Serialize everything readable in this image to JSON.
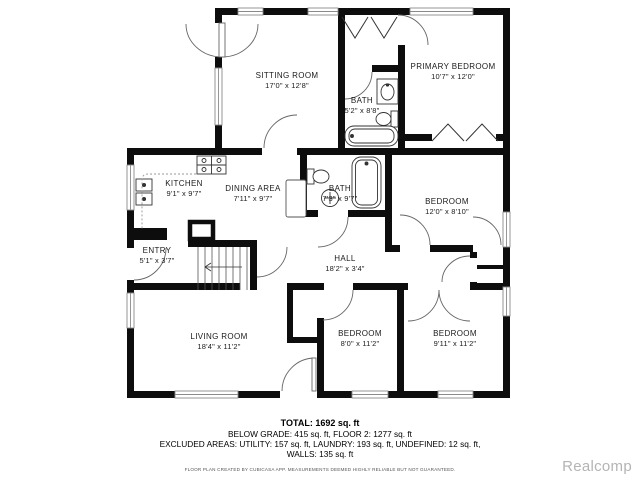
{
  "rooms": {
    "sitting_room": {
      "name": "SITTING ROOM",
      "dims": "17'0\" x 12'8\""
    },
    "bath_upper": {
      "name": "BATH",
      "dims": "5'2\" x 8'8\""
    },
    "primary": {
      "name": "PRIMARY BEDROOM",
      "dims": "10'7\" x 12'0\""
    },
    "kitchen": {
      "name": "KITCHEN",
      "dims": "9'1\" x 9'7\""
    },
    "dining": {
      "name": "DINING AREA",
      "dims": "7'11\" x 9'7\""
    },
    "bath_main": {
      "name": "BATH",
      "dims": "7'3\" x 9'7\""
    },
    "bedroom_right": {
      "name": "BEDROOM",
      "dims": "12'0\" x 8'10\""
    },
    "entry": {
      "name": "ENTRY",
      "dims": "5'1\" x 3'7\""
    },
    "hall": {
      "name": "HALL",
      "dims": "18'2\" x 3'4\""
    },
    "living": {
      "name": "LIVING ROOM",
      "dims": "18'4\" x 11'2\""
    },
    "bedroom_small": {
      "name": "BEDROOM",
      "dims": "8'0\" x 11'2\""
    },
    "bedroom_back": {
      "name": "BEDROOM",
      "dims": "9'11\" x 11'2\""
    }
  },
  "summary": {
    "total": "TOTAL: 1692 sq. ft",
    "grade_line": "BELOW GRADE: 415 sq. ft, FLOOR 2: 1277 sq. ft",
    "excluded_line": "EXCLUDED AREAS: UTILITY: 157 sq. ft, LAUNDRY: 193 sq. ft, UNDEFINED: 12 sq. ft,",
    "walls_line": "WALLS: 135 sq. ft",
    "disclaimer": "FLOOR PLAN CREATED BY CUBICASA APP. MEASUREMENTS DEEMED HIGHLY RELIABLE BUT NOT GUARANTEED."
  },
  "watermark": "Realcomp",
  "colors": {
    "wall": "#0d0d0d",
    "door_arc": "#666666",
    "watermark_gray": "#b4b4b4"
  }
}
